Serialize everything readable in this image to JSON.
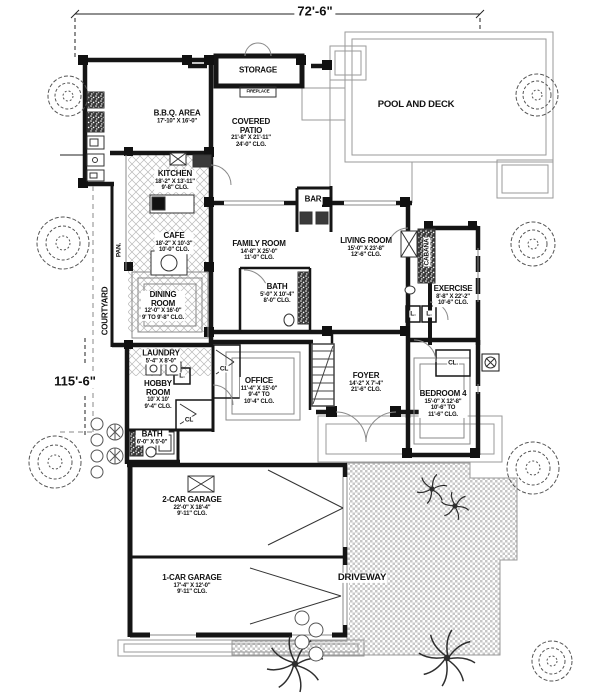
{
  "dimensions": {
    "top": "72'-6\"",
    "left": "115'-6\""
  },
  "rooms": {
    "storage": {
      "name": "STORAGE"
    },
    "fireplace": {
      "name": "FIREPLACE"
    },
    "pool_deck": {
      "name": "POOL AND DECK"
    },
    "bbq": {
      "name": "B.B.Q. AREA",
      "dims": "17'-10\" X 16'-0\""
    },
    "covered_patio": {
      "name": "COVERED\nPATIO",
      "dims": "21'-8\" X 21'-11\"\n24'-0\" CLG."
    },
    "kitchen": {
      "name": "KITCHEN",
      "dims": "18'-2\" X 13'-11\"\n9'-8\" CLG."
    },
    "cafe": {
      "name": "CAFE",
      "dims": "18'-2\" X 10'-3\"\n10'-0\" CLG."
    },
    "bar": {
      "name": "BAR"
    },
    "family_room": {
      "name": "FAMILY ROOM",
      "dims": "14'-8\" X 25'-0\"\n11'-0\" CLG."
    },
    "living_room": {
      "name": "LIVING ROOM",
      "dims": "15'-0\" X 23'-8\"\n12'-6\" CLG."
    },
    "cabana": {
      "name": "CABANA"
    },
    "exercise": {
      "name": "EXERCISE",
      "dims": "8'-8\" X 22'-2\"\n10'-6\" CLG."
    },
    "courtyard": {
      "name": "COURTYARD"
    },
    "pantry": {
      "name": "PAN."
    },
    "dining_room": {
      "name": "DINING\nROOM",
      "dims": "12'-0\" X 16'-0\"\n9' TO 9'-8\" CLG."
    },
    "bath_main": {
      "name": "BATH",
      "dims": "5'-0\" X 10'-4\"\n8'-0\" CLG."
    },
    "laundry": {
      "name": "LAUNDRY",
      "dims": "5'-4\" X 8'-0\""
    },
    "closet_office": {
      "name": "CL"
    },
    "office": {
      "name": "OFFICE",
      "dims": "11'-4\" X 15'-0\"\n9'-4\" TO\n10'-4\" CLG."
    },
    "foyer": {
      "name": "FOYER",
      "dims": "14'-2\" X 7'-4\"\n21'-6\" CLG."
    },
    "bedroom4": {
      "name": "BEDROOM 4",
      "dims": "15'-0\" X 12'-8\"\n10'-6\" TO\n11'-6\" CLG."
    },
    "closet_bedroom": {
      "name": "CL."
    },
    "linen_a": {
      "name": "L."
    },
    "linen_b": {
      "name": "L."
    },
    "linen_c": {
      "name": "L."
    },
    "hobby_room": {
      "name": "HOBBY\nROOM",
      "dims": "10' X 10'\n9'-4\" CLG."
    },
    "closet_hobby": {
      "name": "CL"
    },
    "bath_hobby": {
      "name": "BATH",
      "dims": "6'-0\" X 5'-0\""
    },
    "garage_2": {
      "name": "2-CAR GARAGE",
      "dims": "22'-0\" X 18'-4\"\n9'-11\" CLG."
    },
    "garage_1": {
      "name": "1-CAR GARAGE",
      "dims": "17'-4\" X 12'-0\"\n9'-11\" CLG."
    },
    "driveway": {
      "name": "DRIVEWAY"
    }
  }
}
